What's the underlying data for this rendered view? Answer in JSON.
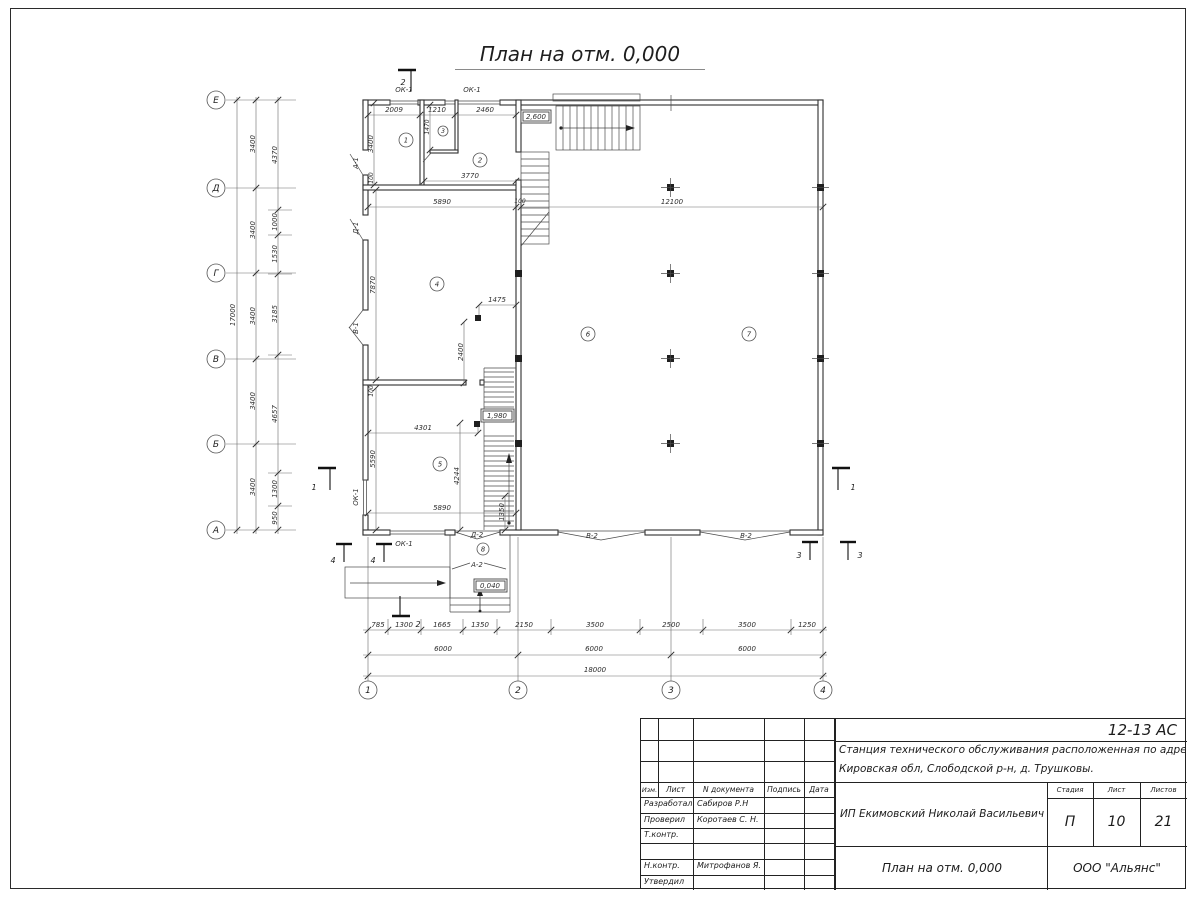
{
  "page": {
    "title": "План на отм. 0,000"
  },
  "axes": {
    "rows": [
      "Е",
      "Д",
      "Г",
      "В",
      "Б",
      "А"
    ],
    "cols": [
      "1",
      "2",
      "3",
      "4"
    ]
  },
  "dims": {
    "left_total": "17000",
    "left_axis": [
      "3400",
      "3400",
      "3400",
      "3400",
      "3400"
    ],
    "left_inner": [
      "4370",
      "1000",
      "1530",
      "3185",
      "4657",
      "1300",
      "950"
    ],
    "bottom_detail": [
      "785",
      "1300",
      "1665",
      "1350",
      "2150",
      "3500",
      "2500",
      "3500",
      "1250"
    ],
    "bottom_axis": [
      "6000",
      "6000",
      "6000"
    ],
    "bottom_total": "18000",
    "top_room": [
      "2009",
      "1210",
      "2460"
    ],
    "v1470": "1470",
    "v3400": "3400",
    "v100_left": "100",
    "h3770": "3770",
    "h5890_top": "5890",
    "h100_mid": "100",
    "h12100": "12100",
    "v7870": "7870",
    "h1475": "1475",
    "v2400": "2400",
    "h4301": "4301",
    "v5590": "5590",
    "v4244": "4244",
    "h5890_bot": "5890",
    "v1350": "1350",
    "v100_mid": "100"
  },
  "rooms": [
    "1",
    "2",
    "3",
    "4",
    "5",
    "6",
    "7",
    "8"
  ],
  "openings": {
    "ok1_top_left": "ОК-1",
    "ok1_top_right": "ОК-1",
    "a1": "А-1",
    "d1": "Д-1",
    "v1": "В-1",
    "ok1_left": "ОК-1",
    "ok1_bottom": "ОК-1",
    "d2": "Д-2",
    "a2": "А-2",
    "v2_left": "В-2",
    "v2_right": "В-2"
  },
  "elevations": {
    "upper": "2,600",
    "stair": "1,980",
    "porch": "0,040"
  },
  "sections": {
    "s1": "1",
    "s2": "2",
    "s3": "3",
    "s4": "4"
  },
  "title_block": {
    "code": "12-13 АС",
    "object_line1": "Станция технического обслуживания расположенная по адресу",
    "object_line2": "Кировская обл, Слободской р-н, д. Трушковы.",
    "client": "ИП Екимовский Николай Васильевич",
    "drawing": "План на отм. 0,000",
    "org": "ООО \"Альянс\"",
    "head": {
      "izm": "Изм.",
      "list": "Лист",
      "ndoc": "N документа",
      "sign": "Подпись",
      "date": "Дата"
    },
    "stage_label": "Стадия",
    "sheet_label": "Лист",
    "sheets_label": "Листов",
    "stage": "П",
    "sheet": "10",
    "sheets": "21",
    "rows": [
      {
        "role": "Разработал",
        "name": "Сабиров Р.Н"
      },
      {
        "role": "Проверил",
        "name": "Коротаев С. Н."
      },
      {
        "role": "Т.контр.",
        "name": ""
      },
      {
        "role": "",
        "name": ""
      },
      {
        "role": "Н.контр.",
        "name": "Митрофанов Я. А."
      },
      {
        "role": "Утвердил",
        "name": ""
      }
    ]
  }
}
